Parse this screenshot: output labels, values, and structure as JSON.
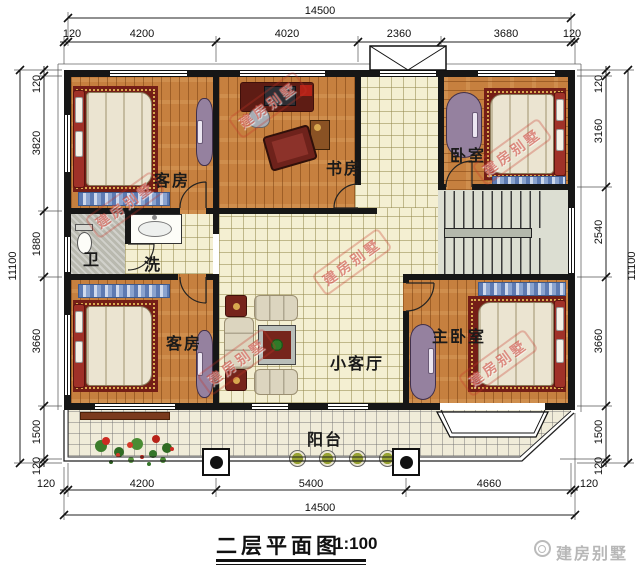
{
  "plan": {
    "title": "二层平面图",
    "scale": "1:100",
    "watermark_text": "建房别墅",
    "brand_text": "建房别墅",
    "rooms": {
      "guest_top": "客房",
      "study": "书房",
      "bedroom_top": "卧室",
      "wc": "卫",
      "wash": "洗",
      "guest_bottom": "客房",
      "living": "小客厅",
      "master": "主卧室",
      "balcony": "阳台"
    }
  },
  "dimensions": {
    "top_total": "14500",
    "top_segments": [
      "120",
      "4200",
      "4020",
      "2360",
      "3680",
      "120"
    ],
    "left_total": "11100",
    "left_segments": [
      "120",
      "3820",
      "1880",
      "3660",
      "1500",
      "120"
    ],
    "right_total": "11100",
    "right_segments": [
      "120",
      "3160",
      "2540",
      "3660",
      "1500",
      "120"
    ],
    "bottom_total": "14500",
    "bottom_segments": [
      "120",
      "4200",
      "5400",
      "4660",
      "120"
    ]
  },
  "colors": {
    "wall": "#161616",
    "wood_floor": "#c6803f",
    "tile_floor": "#f4efd2",
    "wardrobe": "#95819f",
    "watermark_red": "#c63428"
  }
}
